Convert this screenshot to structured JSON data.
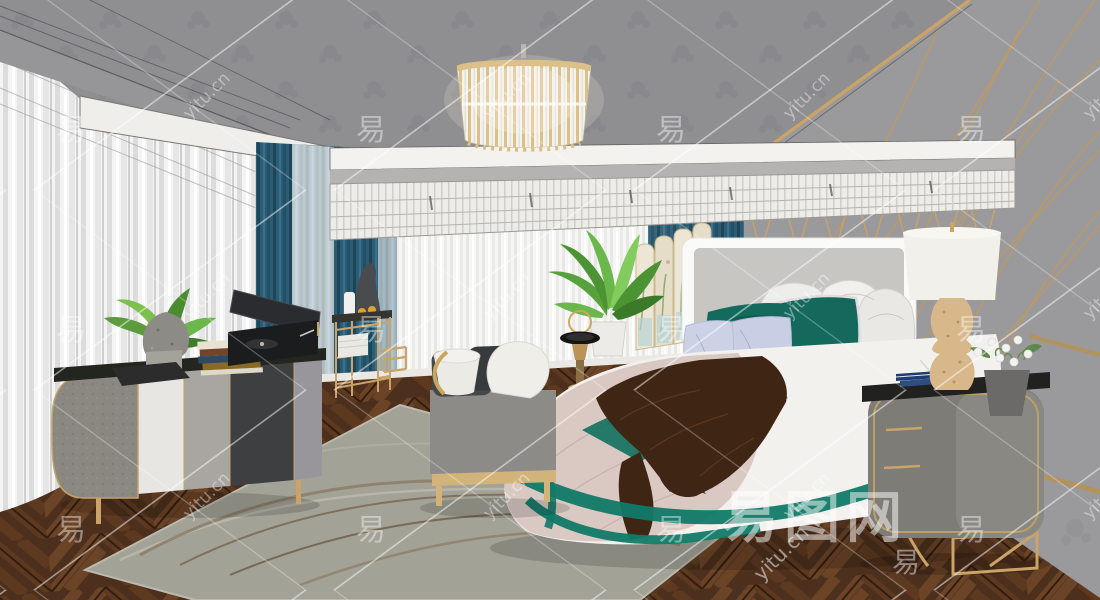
{
  "watermark": {
    "glyph": "易",
    "site": "yitu.cn",
    "brand": "易图网",
    "color": "#ffffff"
  },
  "scene": {
    "type": "3d-interior-render",
    "room": "bedroom"
  },
  "palette": {
    "ceiling_gray": "#8f8e91",
    "wall_gray": "#9a999b",
    "gold": "#c9a368",
    "teal_curtain": "#2a5d75",
    "teal_accent": "#117a68",
    "emerald_pillow": "#156a5e",
    "lavender_pillow": "#c9cee4",
    "blush_blanket": "#dac9c3",
    "fur_brown": "#3f2513",
    "floor_walnut": "#4c2f1c",
    "rug_sage": "#a3a296",
    "sheer_white": "#f4f4f4",
    "crystal_gold": "#dcc089"
  }
}
